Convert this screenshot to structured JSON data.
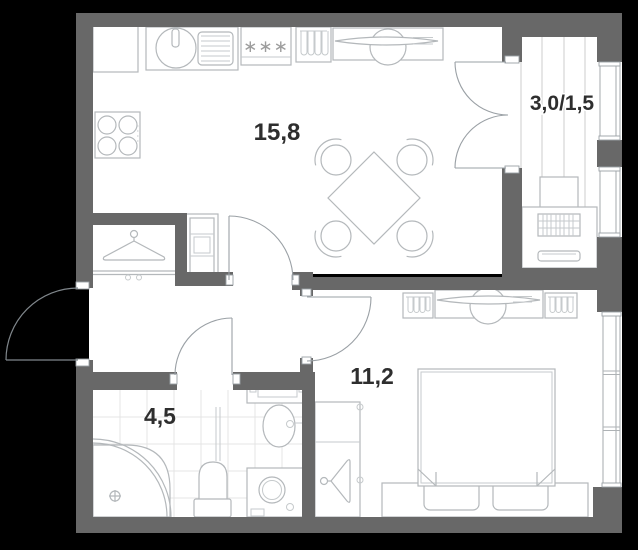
{
  "plan": {
    "title": "one-bedroom apartment floor plan",
    "rooms": [
      {
        "id": "kitchen_living",
        "area_label": "15,8"
      },
      {
        "id": "balcony",
        "area_label": "3,0/1,5"
      },
      {
        "id": "bedroom",
        "area_label": "11,2"
      },
      {
        "id": "bathroom",
        "area_label": "4,5"
      }
    ],
    "symbols": {
      "freezer_stars": "∗∗∗"
    },
    "icons": {
      "fridge": "freezer-stars-icon",
      "sink": "kitchen-sink-icon",
      "hob": "four-burner-hob-icon",
      "dining": "square-table-four-chairs-icon",
      "desk": "desk-with-chair-icon",
      "wardrobe": "hangers-in-cabinet-icon",
      "coat_hanger": "coat-hanger-icon",
      "shower": "corner-shower-icon",
      "toilet": "toilet-icon",
      "washer": "washing-machine-icon",
      "bed": "double-bed-icon",
      "ac_unit": "ac-outdoor-unit-icon"
    },
    "colors": {
      "background": "#000000",
      "walls": "#686868",
      "floor": "#ffffff",
      "furniture_stroke": "#b4b8bb",
      "door_stroke": "#9aa0a5",
      "tile_line": "#e4e4e4",
      "label_text": "#2e2e2e"
    }
  }
}
